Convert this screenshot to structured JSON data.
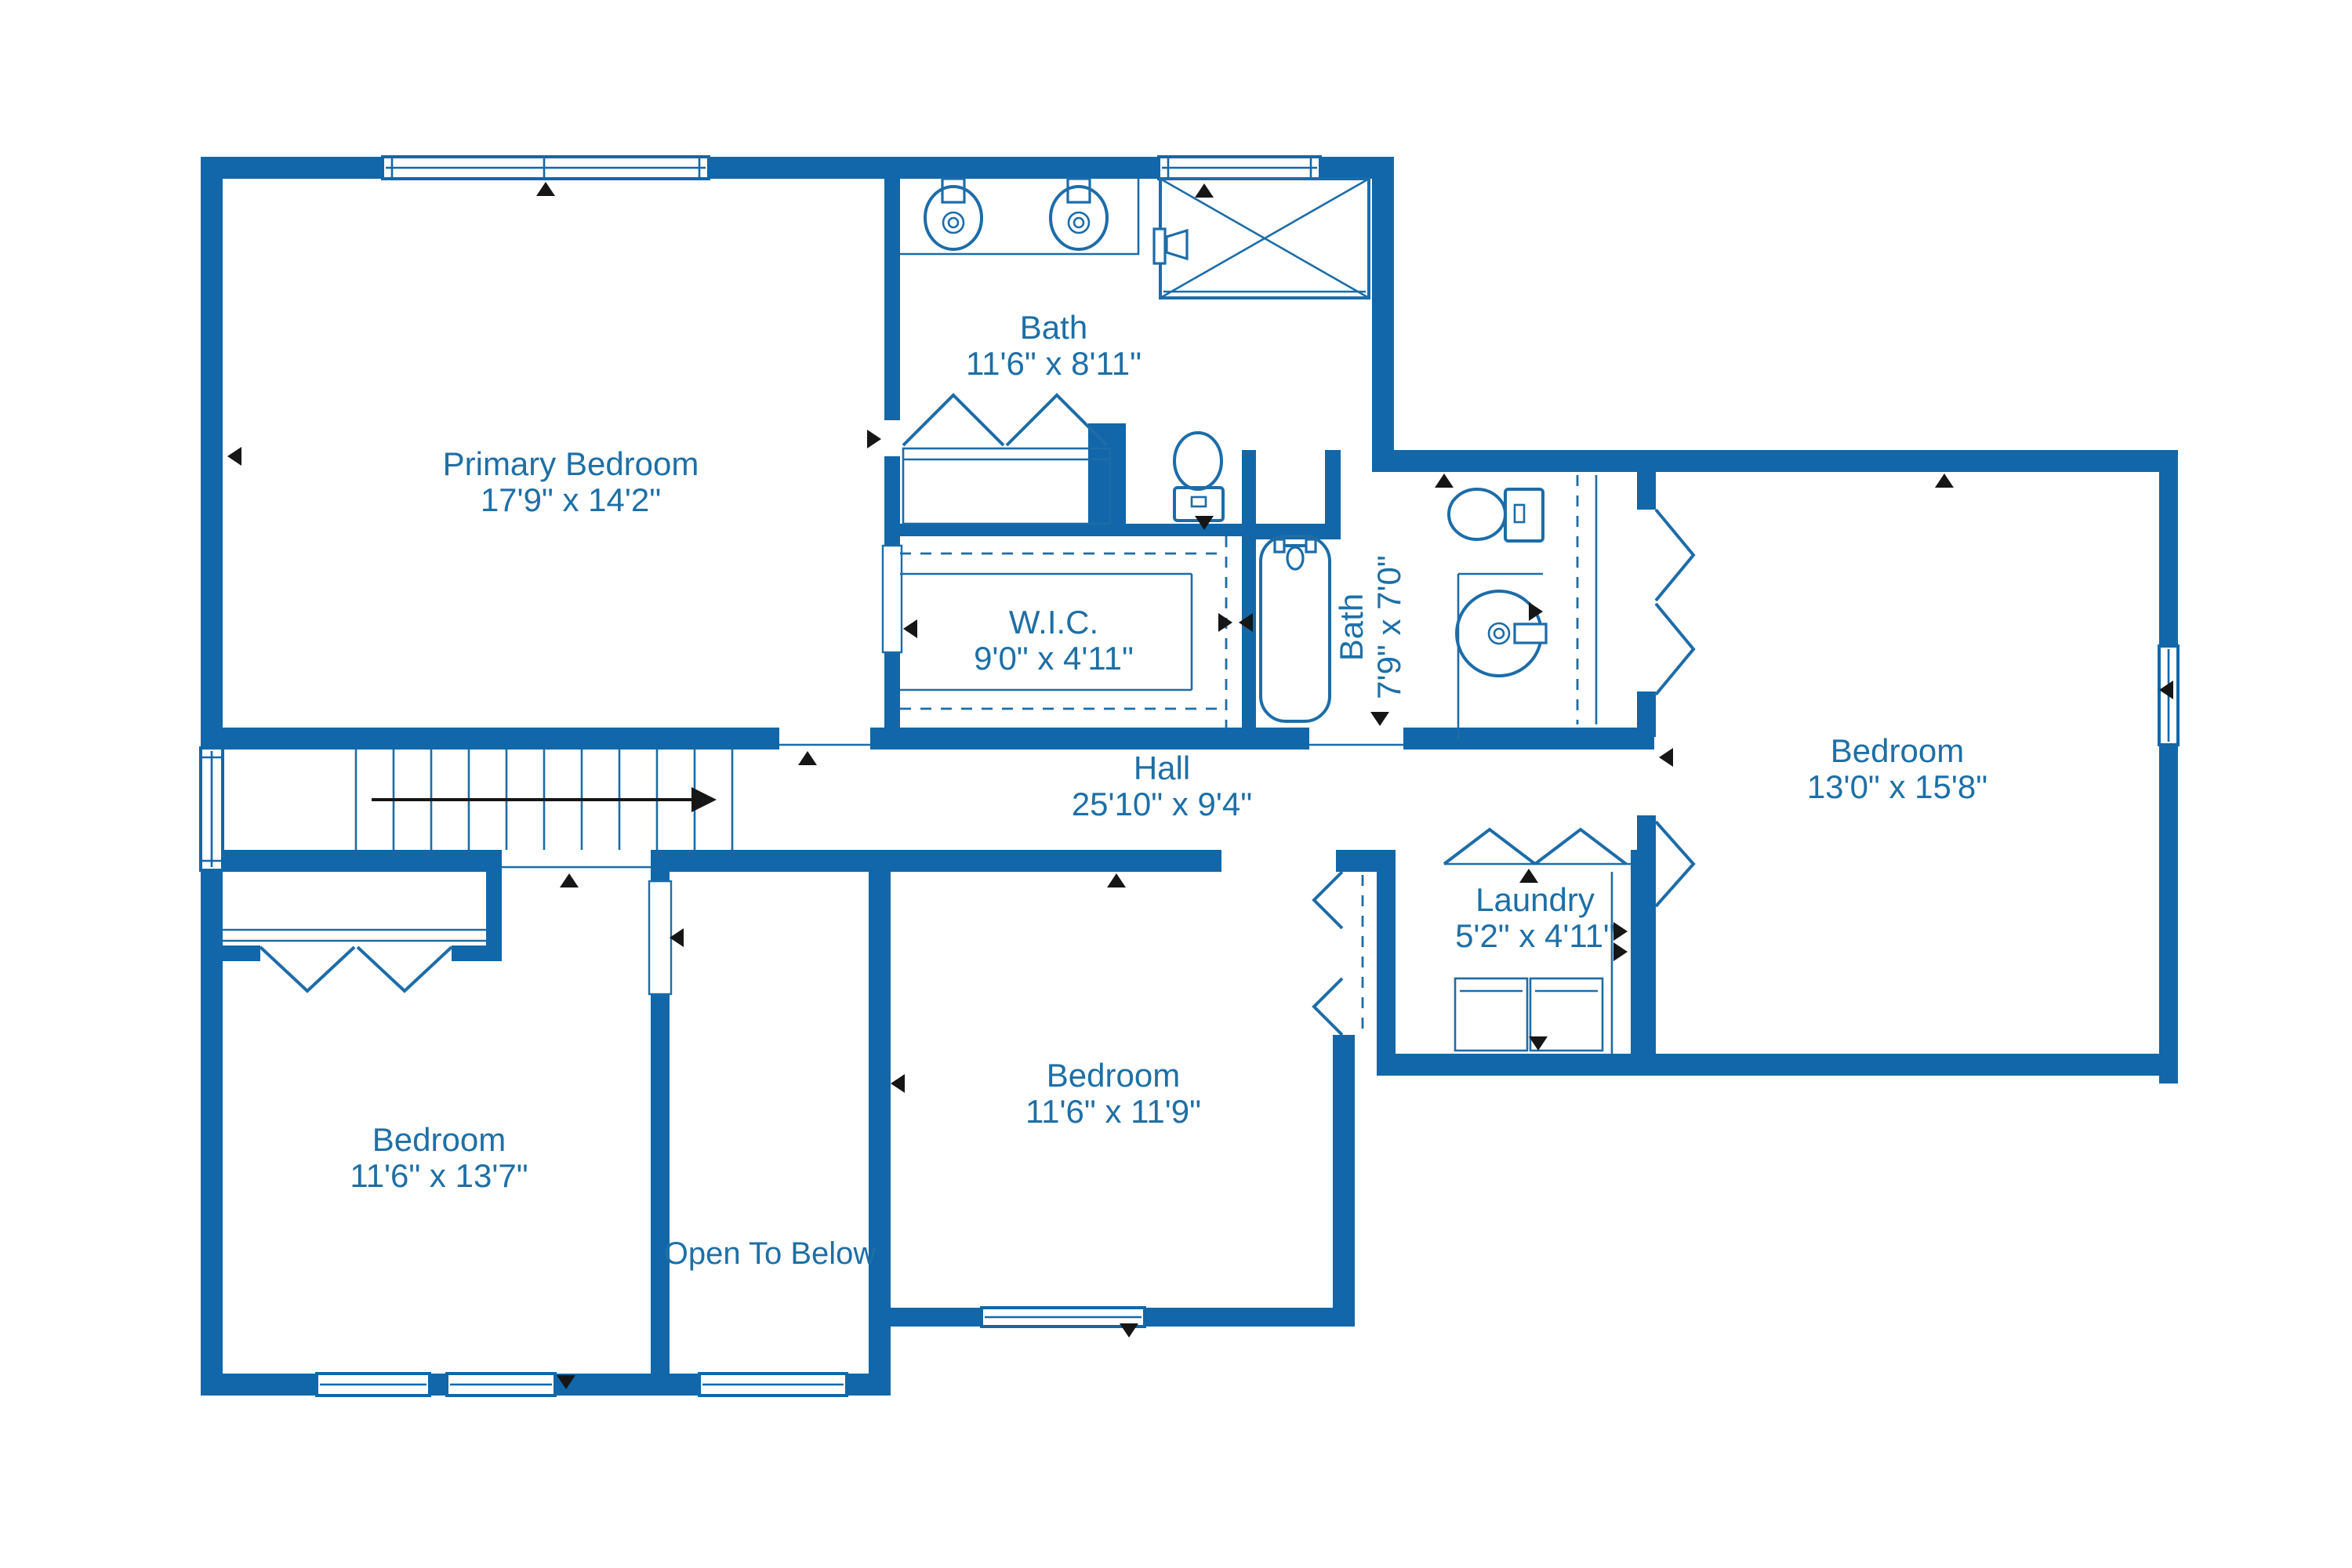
{
  "plan": {
    "title": "Second Floor Plan",
    "colors": {
      "wall": "#1167a9",
      "text": "#1e6fa6",
      "fixture": "#1d6ca8",
      "marker": "#161616",
      "background": "#ffffff"
    },
    "rooms": [
      {
        "id": "primary-bedroom",
        "name": "Primary Bedroom",
        "dims": "17'9\" x 14'2\""
      },
      {
        "id": "bath-main",
        "name": "Bath",
        "dims": "11'6\" x 8'11\""
      },
      {
        "id": "wic",
        "name": "W.I.C.",
        "dims": "9'0\" x 4'11\""
      },
      {
        "id": "bath-hall",
        "name": "Bath",
        "dims": "7'9\" x 7'0\""
      },
      {
        "id": "hall",
        "name": "Hall",
        "dims": "25'10\" x 9'4\""
      },
      {
        "id": "bedroom-right",
        "name": "Bedroom",
        "dims": "13'0\" x 15'8\""
      },
      {
        "id": "laundry",
        "name": "Laundry",
        "dims": "5'2\" x 4'11\""
      },
      {
        "id": "bedroom-middle",
        "name": "Bedroom",
        "dims": "11'6\" x 11'9\""
      },
      {
        "id": "bedroom-left",
        "name": "Bedroom",
        "dims": "11'6\" x 13'7\""
      },
      {
        "id": "open-to-below",
        "name": "Open To Below",
        "dims": ""
      }
    ],
    "fixtures": [
      "double-vanity-sink",
      "shower-stall",
      "toilet",
      "walk-in-closet-rods",
      "bathtub",
      "toilet",
      "round-vanity-sink",
      "washer",
      "dryer",
      "stairs-with-direction-arrow",
      "closet-bifold-doors",
      "windows",
      "door-markers"
    ]
  }
}
